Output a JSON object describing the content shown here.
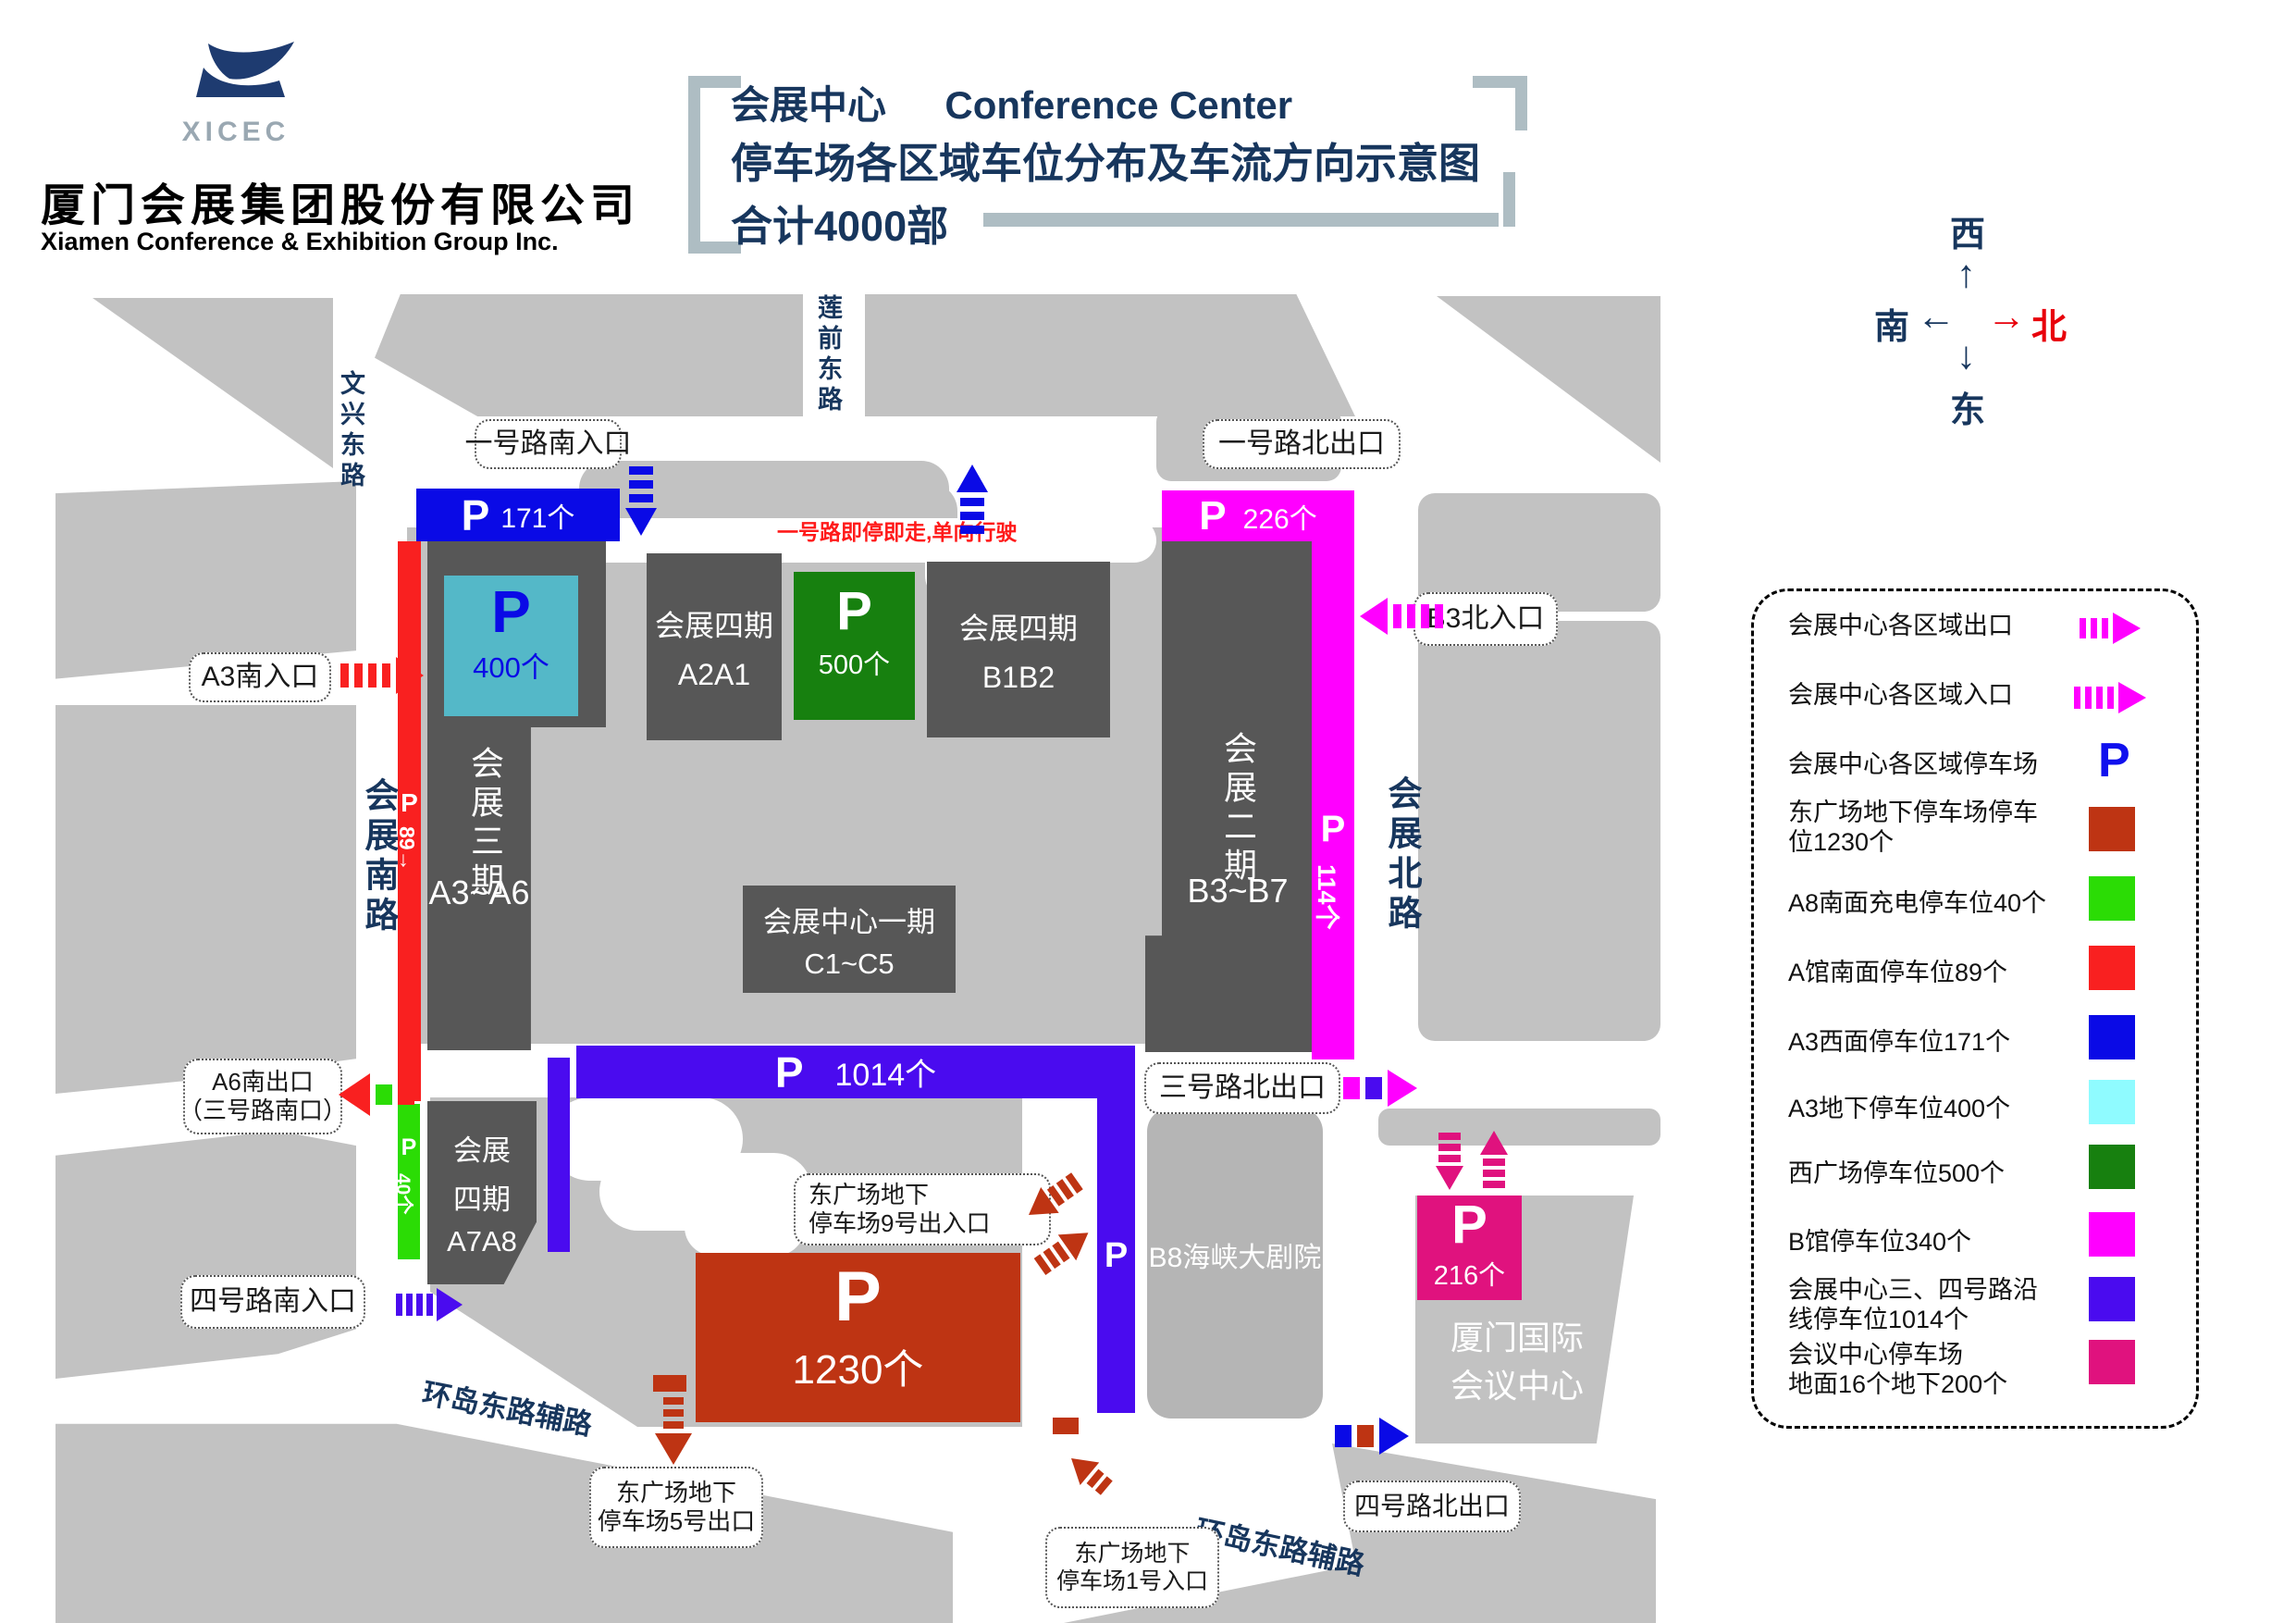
{
  "colors": {
    "navy": "#17365D",
    "gray": "#C2C2C2",
    "grayb8": "#B5B5B5",
    "dark": "#575757",
    "blue": "#0A0AE6",
    "red": "#F92020",
    "teal": "#54B8C8",
    "cyan": "#8FFBFF",
    "dgreen": "#17800F",
    "green": "#2BDC05",
    "magenta": "#FF00FF",
    "violet": "#4A0BEF",
    "pink": "#E0127E",
    "brick": "#BE3413",
    "notered": "#FF1A1A",
    "bracket": "#AEBDC3"
  },
  "header": {
    "logo_acronym": "XICEC",
    "company_cn": "厦门会展集团股份有限公司",
    "company_en": "Xiamen Conference & Exhibition Group Inc.",
    "title_cn": "会展中心",
    "title_en": "Conference Center",
    "subtitle": "停车场各区域车位分布及车流方向示意图",
    "total": "合计4000部"
  },
  "compass": {
    "west": "西",
    "south": "南",
    "north": "北",
    "east": "东",
    "up": "↑",
    "left": "←",
    "right": "→",
    "down": "↓"
  },
  "note": {
    "one_road": "一号路即停即走,单向行驶"
  },
  "roads": {
    "wenxing": "文兴东路",
    "lianqian": "莲前东路",
    "south": "会展南路",
    "north": "会展北路",
    "ring_left": "环岛东路辅路",
    "ring_right": "环岛东路辅路"
  },
  "boxes": {
    "entry1s": "一号路南入口",
    "exit1n": "一号路北出口",
    "b3n": "B3北入口",
    "a3s": "A3南入口",
    "a6s_l1": "A6南出口",
    "a6s_l2": "（三号路南口）",
    "entry4s": "四号路南入口",
    "exit3n": "三号路北出口",
    "exit4n": "四号路北出口",
    "no9_l1": "东广场地下",
    "no9_l2": "停车场9号出入口",
    "no5_l1": "东广场地下",
    "no5_l2": "停车场5号出口",
    "no1_l1": "东广场地下",
    "no1_l2": "停车场1号入口"
  },
  "buildings": {
    "phase3_v": "会展三期",
    "phase3_sub": "A3~A6",
    "phase4a_l1": "会展四期",
    "phase4a_l2": "A2A1",
    "phase4b_l1": "会展四期",
    "phase4b_l2": "B1B2",
    "phase1_l1": "会展中心一期",
    "phase1_l2": "C1~C5",
    "phase2_v": "会展二期",
    "phase2_sub": "B3~B7",
    "phase4c_l1": "会展",
    "phase4c_l2": "四期",
    "phase4c_l3": "A7A8",
    "b8": "B8海峡大剧院",
    "icc_l1": "厦门国际",
    "icc_l2": "会议中心"
  },
  "parking": {
    "p": "P",
    "n171": "171个",
    "n400": "400个",
    "n500": "500个",
    "n226": "226个",
    "n114": "114个",
    "n89": "89→",
    "n40": "40个",
    "n1014": "1014个",
    "n1230": "1230个",
    "n216": "216个"
  },
  "legend": {
    "items": [
      {
        "l1": "会展中心各区域出口",
        "l2": ""
      },
      {
        "l1": "会展中心各区域入口",
        "l2": ""
      },
      {
        "l1": "会展中心各区域停车场",
        "l2": ""
      },
      {
        "l1": "东广场地下停车场停车",
        "l2": "位1230个"
      },
      {
        "l1": "A8南面充电停车位40个",
        "l2": ""
      },
      {
        "l1": "A馆南面停车位89个",
        "l2": ""
      },
      {
        "l1": "A3西面停车位171个",
        "l2": ""
      },
      {
        "l1": "A3地下停车位400个",
        "l2": ""
      },
      {
        "l1": "西广场停车位500个",
        "l2": ""
      },
      {
        "l1": "B馆停车位340个",
        "l2": ""
      },
      {
        "l1": "会展中心三、四号路沿",
        "l2": "线停车位1014个"
      },
      {
        "l1": "会议中心停车场",
        "l2": "地面16个地下200个"
      }
    ]
  }
}
